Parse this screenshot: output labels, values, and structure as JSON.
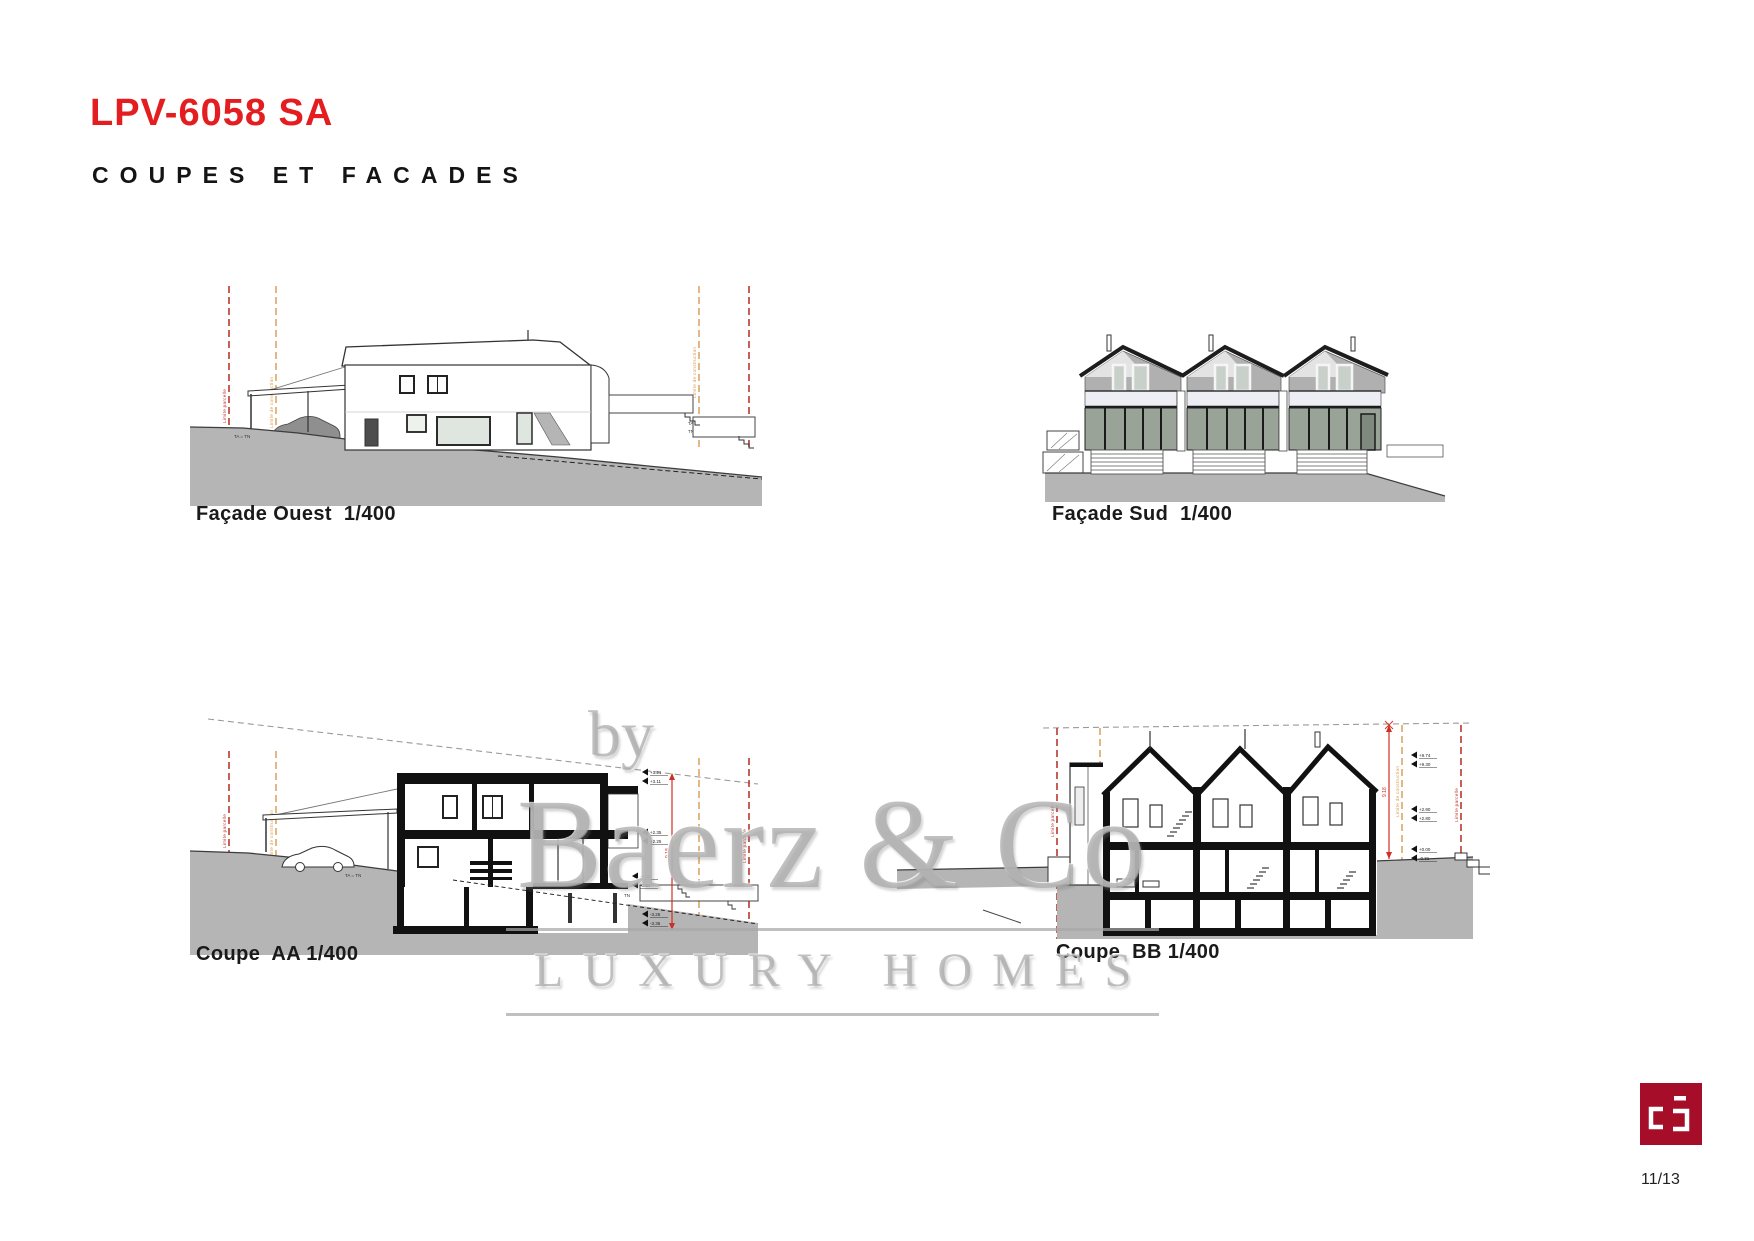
{
  "page": {
    "title": "LPV-6058 SA",
    "subtitle": "COUPES ET FACADES",
    "page_number": "11/13"
  },
  "colors": {
    "accent_red": "#e41e20",
    "logo_red": "#a50d28",
    "terrain_gray": "#b5b5b5",
    "limit_line_red": "#b8392e",
    "limit_line_orange": "#d99a4e",
    "dimension_red": "#d03024"
  },
  "watermark": {
    "by": "by",
    "name": "Baerz & Co",
    "tagline": "LUXURY HOMES"
  },
  "annotations": {
    "limite_parcelle": "Limite parcelle",
    "limite_construction": "Limite de construction",
    "ta_tn": "TA = TN",
    "ta": "TA",
    "tn": "TN",
    "dim_height": "9.18"
  },
  "drawings": {
    "facade_ouest": {
      "label": "Façade Ouest  1/400"
    },
    "facade_sud": {
      "label": "Façade Sud  1/400"
    },
    "coupe_aa": {
      "label": "Coupe  AA 1/400",
      "markers": [
        "+3.21",
        "+3.11",
        "+2.35",
        "+2.25",
        "-0.24",
        "-0.34",
        "-3.26",
        "-3.36"
      ]
    },
    "coupe_bb": {
      "label": "Coupe  BB 1/400",
      "markers": [
        "+9.74",
        "+9.30",
        "+2.90",
        "+2.80",
        "+0.00",
        "-0.31"
      ]
    }
  }
}
